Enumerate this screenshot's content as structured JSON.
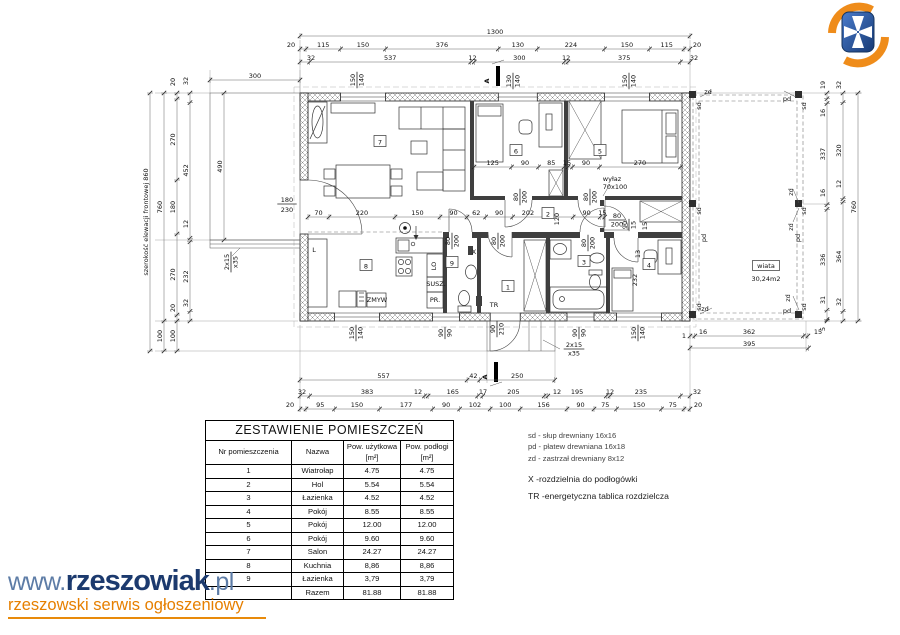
{
  "branding": {
    "www": "www.",
    "name": "rzeszowiak",
    "tld": ".pl",
    "tagline": "rzeszowski serwis ogłoszeniowy"
  },
  "rooms_table": {
    "title": "ZESTAWIENIE POMIESZCZEŃ",
    "headers": [
      "Nr pomieszczenia",
      "Nazwa",
      "Pow. użytkowa [m²]",
      "Pow. podłogi [m²]"
    ],
    "rows": [
      [
        "1",
        "Wiatrołap",
        "4.75",
        "4.75"
      ],
      [
        "2",
        "Hol",
        "5.54",
        "5.54"
      ],
      [
        "3",
        "Łazienka",
        "4.52",
        "4.52"
      ],
      [
        "4",
        "Pokój",
        "8.55",
        "8.55"
      ],
      [
        "5",
        "Pokój",
        "12.00",
        "12.00"
      ],
      [
        "6",
        "Pokój",
        "9.60",
        "9.60"
      ],
      [
        "7",
        "Salon",
        "24.27",
        "24.27"
      ],
      [
        "8",
        "Kuchnia",
        "8,86",
        "8,86"
      ],
      [
        "9",
        "Łazienka",
        "3,79",
        "3,79"
      ],
      [
        "",
        "Razem",
        "81.88",
        "81.88"
      ]
    ]
  },
  "legend": {
    "wood": [
      "sd - słup drewniany 16x16",
      "pd - płatew drewniana 16x18",
      "zd - zastrzał drewniany 8x12"
    ],
    "x_note": "X -rozdzielnia do podłogówki",
    "tr_note": "TR -energetyczna tablica rozdzielcza"
  },
  "plan": {
    "scale": 0.3,
    "chains_h": [
      {
        "y": 36,
        "x0": 300,
        "v": [
          1300
        ]
      },
      {
        "y": 49,
        "x0": 300,
        "v": [
          {
            "v": 20,
            "lx": 291
          },
          115,
          150,
          376,
          130,
          224,
          150,
          115,
          {
            "v": 20,
            "lx": 697
          }
        ]
      },
      {
        "y": 62,
        "x0": 300,
        "v": [
          {
            "v": 32,
            "lx": 311
          },
          537,
          12,
          300,
          12,
          375,
          {
            "v": 32,
            "lx": 694
          }
        ]
      },
      {
        "y": 80,
        "x0": 210,
        "v": [
          300
        ]
      },
      {
        "y": 217,
        "x0": 308,
        "v": [
          70,
          220,
          150,
          90,
          62,
          90,
          {
            "v": 202,
            "lx": 528
          },
          90,
          15
        ]
      },
      {
        "y": 167,
        "x0": 474,
        "v": [
          125,
          90,
          85
        ]
      },
      {
        "y": 167,
        "x0": 568,
        "v": [
          {
            "v": 15,
            "lx": 567
          },
          90,
          270
        ]
      },
      {
        "y": 380,
        "x0": 300,
        "v": [
          557,
          42,
          250
        ]
      },
      {
        "y": 396,
        "x0": 300,
        "v": [
          {
            "v": 32,
            "lx": 302
          },
          383,
          {
            "v": 12,
            "lx": 418
          },
          165,
          {
            "v": 17,
            "lx": 483
          },
          205,
          {
            "v": 12,
            "lx": 557
          },
          195,
          {
            "v": 12,
            "lx": 610
          },
          {
            "v": 235,
            "lx": 641
          },
          {
            "v": 32,
            "lx": 697
          }
        ]
      },
      {
        "y": 409,
        "x0": 300,
        "v": [
          {
            "v": 20,
            "lx": 290
          },
          95,
          150,
          177,
          90,
          102,
          100,
          156,
          90,
          75,
          150,
          75,
          {
            "v": 20,
            "lx": 698
          }
        ]
      },
      {
        "y": 336,
        "x0": 690,
        "v": [
          {
            "v": 16,
            "lx": 703
          },
          362,
          {
            "v": 15,
            "lx": 818
          }
        ]
      },
      {
        "y": 348,
        "x0": 690,
        "v": [
          395
        ]
      }
    ],
    "chains_v": [
      {
        "x": 150,
        "y0": 93,
        "v": [
          860
        ],
        "label": "szerokość elewacji frontowej  860"
      },
      {
        "x": 164,
        "y0": 93,
        "v": [
          760,
          100
        ]
      },
      {
        "x": 177,
        "y0": 93,
        "v": [
          {
            "v": 20,
            "ly": 82
          },
          270,
          180,
          270,
          {
            "v": 20,
            "ly": 308
          },
          100
        ]
      },
      {
        "x": 190,
        "y0": 93,
        "v": [
          {
            "v": 32,
            "ly": 81
          },
          452,
          {
            "v": 12,
            "ly": 224
          },
          232,
          {
            "v": 32,
            "ly": 303
          }
        ]
      },
      {
        "x": 224,
        "y0": 93,
        "v": [
          490
        ]
      },
      {
        "x": 827,
        "y0": 93,
        "v": [
          {
            "v": 19,
            "ly": 85
          },
          {
            "v": 16,
            "ly": 113
          },
          337,
          {
            "v": 16,
            "ly": 193
          },
          336,
          {
            "v": 31,
            "ly": 300
          },
          {
            "v": 5,
            "ly": 329
          }
        ]
      },
      {
        "x": 843,
        "y0": 93,
        "v": [
          {
            "v": 32,
            "ly": 85
          },
          320,
          {
            "v": 12,
            "ly": 184
          },
          364,
          {
            "v": 32,
            "ly": 302
          }
        ]
      },
      {
        "x": 858,
        "y0": 93,
        "v": [
          760
        ]
      }
    ],
    "labels": [
      {
        "t": "A",
        "x": 489,
        "y": 81,
        "r": -90,
        "fs": 10,
        "b": 1
      },
      {
        "t": "A",
        "x": 487,
        "y": 377,
        "r": -90,
        "fs": 10,
        "b": 1
      },
      {
        "t": "wiata",
        "x": 766,
        "y": 268,
        "fs": 7,
        "box": 1
      },
      {
        "t": "30,24m2",
        "x": 766,
        "y": 281,
        "fs": 7
      },
      {
        "t": "sd",
        "x": 701,
        "y": 106,
        "r": -90,
        "fs": 5.5
      },
      {
        "t": "sd",
        "x": 701,
        "y": 211,
        "r": -90,
        "fs": 5.5
      },
      {
        "t": "sd",
        "x": 701,
        "y": 307,
        "r": -90,
        "fs": 5.5
      },
      {
        "t": "sd",
        "x": 806,
        "y": 106,
        "r": -90,
        "fs": 5.5
      },
      {
        "t": "sd",
        "x": 806,
        "y": 211,
        "r": -90,
        "fs": 5.5
      },
      {
        "t": "sd",
        "x": 806,
        "y": 307,
        "r": -90,
        "fs": 5.5
      },
      {
        "t": "pd",
        "x": 787,
        "y": 101,
        "fs": 5.5
      },
      {
        "t": "pd",
        "x": 706,
        "y": 238,
        "r": -90,
        "fs": 5.5
      },
      {
        "t": "pd",
        "x": 800,
        "y": 238,
        "r": -90,
        "fs": 5.5
      },
      {
        "t": "pd",
        "x": 787,
        "y": 313,
        "fs": 5.5
      },
      {
        "t": "zd",
        "x": 708,
        "y": 94,
        "fs": 5.5
      },
      {
        "t": "zd",
        "x": 793,
        "y": 192,
        "r": -90,
        "fs": 5.5
      },
      {
        "t": "zd",
        "x": 793,
        "y": 227,
        "r": -90,
        "fs": 5.5
      },
      {
        "t": "zd",
        "x": 705,
        "y": 311,
        "fs": 5.5
      },
      {
        "t": "zd",
        "x": 790,
        "y": 298,
        "r": -90,
        "fs": 5.5
      },
      {
        "t": "1",
        "x": 684,
        "y": 338,
        "fs": 6
      },
      {
        "t": "wyłaz",
        "x": 612,
        "y": 181,
        "fs": 6.5
      },
      {
        "t": "70x100",
        "x": 615,
        "y": 189,
        "fs": 6.5
      },
      {
        "t": "X",
        "x": 474,
        "y": 254,
        "fs": 8
      },
      {
        "t": "TR",
        "x": 494,
        "y": 307,
        "fs": 8
      },
      {
        "t": "ZMYW",
        "x": 377,
        "y": 302,
        "fs": 4.6
      },
      {
        "t": "SUSZ.",
        "x": 436,
        "y": 286,
        "fs": 5.4
      },
      {
        "t": "PR.",
        "x": 435,
        "y": 302,
        "fs": 5.4
      },
      {
        "t": "LO",
        "x": 436,
        "y": 266,
        "r": -90,
        "fs": 5
      },
      {
        "t": "L",
        "x": 314,
        "y": 252,
        "fs": 6
      },
      {
        "t": "13",
        "x": 640,
        "y": 254,
        "r": -90,
        "fs": 5.4
      },
      {
        "t": "15",
        "x": 647,
        "y": 226,
        "r": -90,
        "fs": 5.4
      },
      {
        "t": "232",
        "x": 637,
        "y": 280,
        "r": -90
      },
      {
        "t": "120",
        "x": 559,
        "y": 219,
        "r": -90
      }
    ],
    "fracs": [
      {
        "a": "150",
        "b": "140",
        "x": 357,
        "y": 80,
        "r": -90
      },
      {
        "a": "130",
        "b": "140",
        "x": 513,
        "y": 81,
        "r": -90
      },
      {
        "a": "150",
        "b": "140",
        "x": 629,
        "y": 81,
        "r": -90
      },
      {
        "a": "180",
        "b": "230",
        "x": 287,
        "y": 204,
        "fs": 8
      },
      {
        "a": "2x15",
        "b": "x35",
        "x": 231,
        "y": 262,
        "r": -90
      },
      {
        "a": "150",
        "b": "140",
        "x": 356,
        "y": 333,
        "r": -90
      },
      {
        "a": "90",
        "b": "90",
        "x": 445,
        "y": 333,
        "r": -90
      },
      {
        "a": "90",
        "b": "210",
        "x": 497,
        "y": 329,
        "r": -90
      },
      {
        "a": "90",
        "b": "90",
        "x": 579,
        "y": 333,
        "r": -90
      },
      {
        "a": "150",
        "b": "140",
        "x": 638,
        "y": 333,
        "r": -90
      },
      {
        "a": "2x15",
        "b": "x35",
        "x": 574,
        "y": 349
      },
      {
        "a": "80",
        "b": "200",
        "x": 520,
        "y": 197,
        "r": -90
      },
      {
        "a": "80",
        "b": "200",
        "x": 590,
        "y": 197,
        "r": -90
      },
      {
        "a": "80",
        "b": "200",
        "x": 452,
        "y": 241,
        "r": -90
      },
      {
        "a": "80",
        "b": "200",
        "x": 498,
        "y": 241,
        "r": -90
      },
      {
        "a": "80",
        "b": "200",
        "x": 588,
        "y": 243,
        "r": -90
      },
      {
        "a": "80",
        "b": "200",
        "x": 617,
        "y": 220
      },
      {
        "a": "90",
        "b": "15",
        "x": 629,
        "y": 225,
        "r": -90
      }
    ],
    "room_boxes": [
      {
        "n": "7",
        "x": 380,
        "y": 143
      },
      {
        "n": "6",
        "x": 516,
        "y": 152
      },
      {
        "n": "5",
        "x": 600,
        "y": 152
      },
      {
        "n": "2",
        "x": 548,
        "y": 215
      },
      {
        "n": "8",
        "x": 366,
        "y": 267
      },
      {
        "n": "9",
        "x": 452,
        "y": 264
      },
      {
        "n": "3",
        "x": 584,
        "y": 263
      },
      {
        "n": "4",
        "x": 649,
        "y": 266
      },
      {
        "n": "1",
        "x": 508,
        "y": 288
      }
    ]
  }
}
